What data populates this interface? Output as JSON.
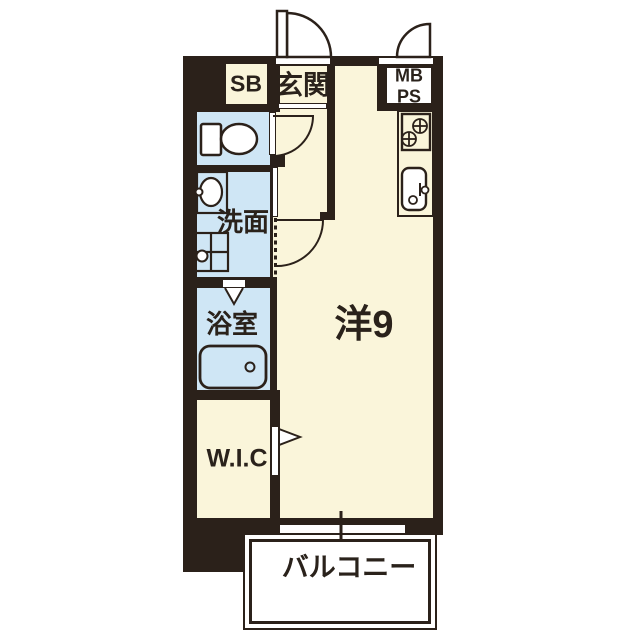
{
  "title": "apartment-floor-plan",
  "colors": {
    "wall": "#2B211A",
    "floor": "#FAF5DA",
    "wet": "#CFE6F5",
    "ink": "#2A221B",
    "paper": "#FFFFFF"
  },
  "rooms": {
    "shoe_box": {
      "label": "SB"
    },
    "entrance": {
      "label": "玄関"
    },
    "meter_box": {
      "label": "MB"
    },
    "pipe_space": {
      "label": "PS"
    },
    "washroom": {
      "label": "洗面"
    },
    "bathroom": {
      "label": "浴室"
    },
    "walk_in_closet": {
      "label": "W.I.C"
    },
    "main_room": {
      "label": "洋9"
    },
    "balcony": {
      "label": "バルコニー"
    }
  },
  "fixtures": {
    "toilet": "toilet-icon",
    "washbasin": "washbasin-icon",
    "washing_machine": "washing-machine-icon",
    "bathtub": "bathtub-icon",
    "stove_burners": "stove-burners-icon",
    "kitchen_sink": "kitchen-sink-icon",
    "entrance_door": "door-swing-icon",
    "meter_box_door": "door-swing-icon",
    "toilet_door": "door-swing-icon",
    "washroom_door": "door-swing-icon",
    "bathroom_door": "folding-door-icon",
    "closet_door": "folding-door-icon",
    "window": "window-icon"
  }
}
